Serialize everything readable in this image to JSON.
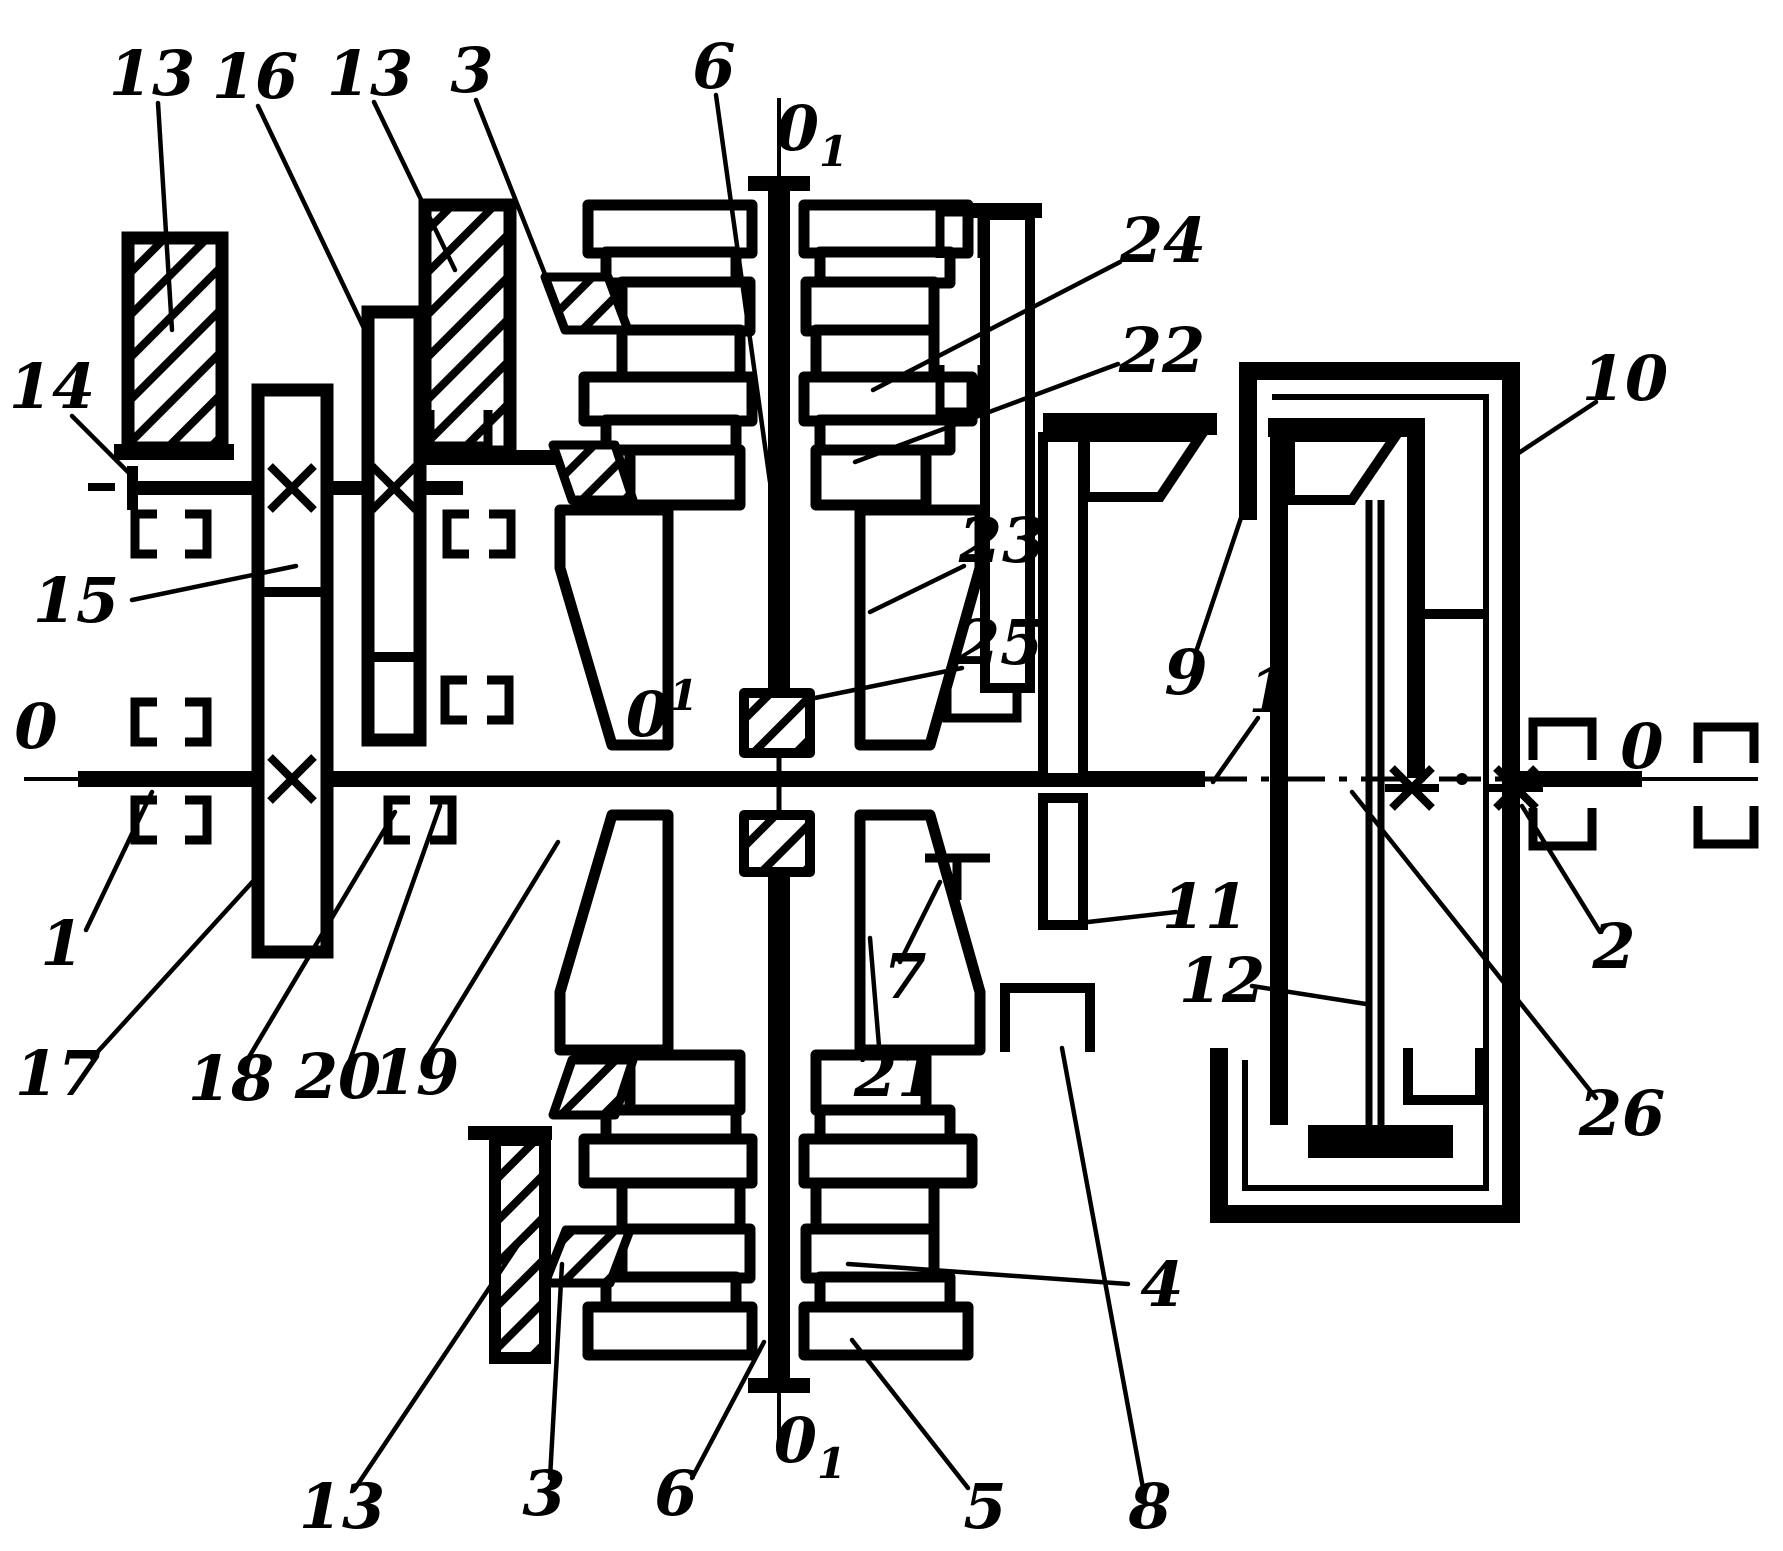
{
  "figure": {
    "kind": "kinematic-diagram",
    "ink_color": "#000000",
    "background_color": "#ffffff",
    "main_axis_name": "0 — 0",
    "planet_axis_name": "O1 — O1"
  },
  "labels": [
    {
      "id": "13-top-left",
      "text": "13",
      "x": 152,
      "y": 95,
      "leader": [
        158,
        103,
        172,
        330
      ]
    },
    {
      "id": "16",
      "text": "16",
      "x": 255,
      "y": 98,
      "leader": [
        258,
        106,
        372,
        345
      ]
    },
    {
      "id": "13-top-mid",
      "text": "13",
      "x": 370,
      "y": 95,
      "leader": [
        374,
        102,
        455,
        270
      ]
    },
    {
      "id": "3-top",
      "text": "3",
      "x": 472,
      "y": 92,
      "leader": [
        476,
        100,
        552,
        292
      ]
    },
    {
      "id": "6-top",
      "text": "6",
      "x": 714,
      "y": 88,
      "leader": [
        716,
        95,
        770,
        482
      ]
    },
    {
      "id": "O1-top",
      "text": "0",
      "sub": "1",
      "x": 812,
      "y": 150,
      "leader": null
    },
    {
      "id": "24",
      "text": "24",
      "x": 1163,
      "y": 262,
      "leader": [
        1120,
        262,
        873,
        390
      ]
    },
    {
      "id": "22",
      "text": "22",
      "x": 1162,
      "y": 372,
      "leader": [
        1118,
        364,
        855,
        462
      ]
    },
    {
      "id": "10",
      "text": "10",
      "x": 1625,
      "y": 400,
      "leader": [
        1596,
        402,
        1505,
        462
      ]
    },
    {
      "id": "14",
      "text": "14",
      "x": 52,
      "y": 408,
      "leader": [
        72,
        416,
        128,
        472
      ]
    },
    {
      "id": "15",
      "text": "15",
      "x": 76,
      "y": 622,
      "leader": [
        132,
        600,
        296,
        566
      ]
    },
    {
      "id": "23",
      "text": "23",
      "x": 1002,
      "y": 562,
      "leader": [
        964,
        566,
        870,
        612
      ]
    },
    {
      "id": "25",
      "text": "25",
      "x": 1000,
      "y": 664,
      "leader": [
        962,
        668,
        805,
        700
      ]
    },
    {
      "id": "0-center",
      "text": "0",
      "sup": "1",
      "x": 662,
      "y": 736,
      "leader": null
    },
    {
      "id": "9",
      "text": "9",
      "x": 1186,
      "y": 694,
      "leader": [
        1196,
        652,
        1247,
        500
      ]
    },
    {
      "id": "1-right",
      "text": "1",
      "x": 1270,
      "y": 712,
      "leader": [
        1258,
        718,
        1213,
        782
      ]
    },
    {
      "id": "0-left",
      "text": "0",
      "x": 36,
      "y": 748,
      "leader": null
    },
    {
      "id": "0-right",
      "text": "0",
      "x": 1642,
      "y": 768,
      "leader": null
    },
    {
      "id": "1-left",
      "text": "1",
      "x": 62,
      "y": 965,
      "leader": [
        86,
        930,
        152,
        792
      ]
    },
    {
      "id": "2",
      "text": "2",
      "x": 1614,
      "y": 968,
      "leader": [
        1600,
        932,
        1522,
        806
      ]
    },
    {
      "id": "17",
      "text": "17",
      "x": 58,
      "y": 1095,
      "leader": [
        92,
        1058,
        256,
        878
      ]
    },
    {
      "id": "18",
      "text": "18",
      "x": 231,
      "y": 1100,
      "leader": [
        246,
        1062,
        395,
        812
      ]
    },
    {
      "id": "20",
      "text": "20",
      "x": 338,
      "y": 1098,
      "leader": [
        350,
        1060,
        440,
        806
      ]
    },
    {
      "id": "19",
      "text": "19",
      "x": 416,
      "y": 1094,
      "leader": [
        428,
        1055,
        558,
        842
      ]
    },
    {
      "id": "7",
      "text": "7",
      "x": 905,
      "y": 998,
      "leader": [
        900,
        962,
        940,
        882
      ]
    },
    {
      "id": "21",
      "text": "21",
      "x": 897,
      "y": 1096,
      "leader": [
        880,
        1058,
        870,
        938
      ]
    },
    {
      "id": "11",
      "text": "11",
      "x": 1205,
      "y": 928,
      "leader": [
        1176,
        912,
        1088,
        922
      ]
    },
    {
      "id": "12",
      "text": "12",
      "x": 1222,
      "y": 1002,
      "leader": [
        1252,
        986,
        1366,
        1004
      ]
    },
    {
      "id": "26",
      "text": "26",
      "x": 1622,
      "y": 1135,
      "leader": [
        1596,
        1098,
        1352,
        792
      ]
    },
    {
      "id": "4",
      "text": "4",
      "x": 1162,
      "y": 1306,
      "leader": [
        1128,
        1284,
        848,
        1264
      ]
    },
    {
      "id": "5",
      "text": "5",
      "x": 985,
      "y": 1528,
      "leader": [
        968,
        1488,
        852,
        1340
      ]
    },
    {
      "id": "8",
      "text": "8",
      "x": 1150,
      "y": 1528,
      "leader": [
        1143,
        1488,
        1062,
        1048
      ]
    },
    {
      "id": "13-bottom",
      "text": "13",
      "x": 342,
      "y": 1528,
      "leader": [
        354,
        1490,
        520,
        1242
      ]
    },
    {
      "id": "3-bottom",
      "text": "3",
      "x": 544,
      "y": 1515,
      "leader": [
        550,
        1478,
        562,
        1264
      ]
    },
    {
      "id": "6-bottom",
      "text": "6",
      "x": 676,
      "y": 1515,
      "leader": [
        692,
        1478,
        764,
        1342
      ]
    },
    {
      "id": "O1-bottom",
      "text": "0",
      "sub": "1",
      "x": 810,
      "y": 1462,
      "leader": null
    }
  ]
}
